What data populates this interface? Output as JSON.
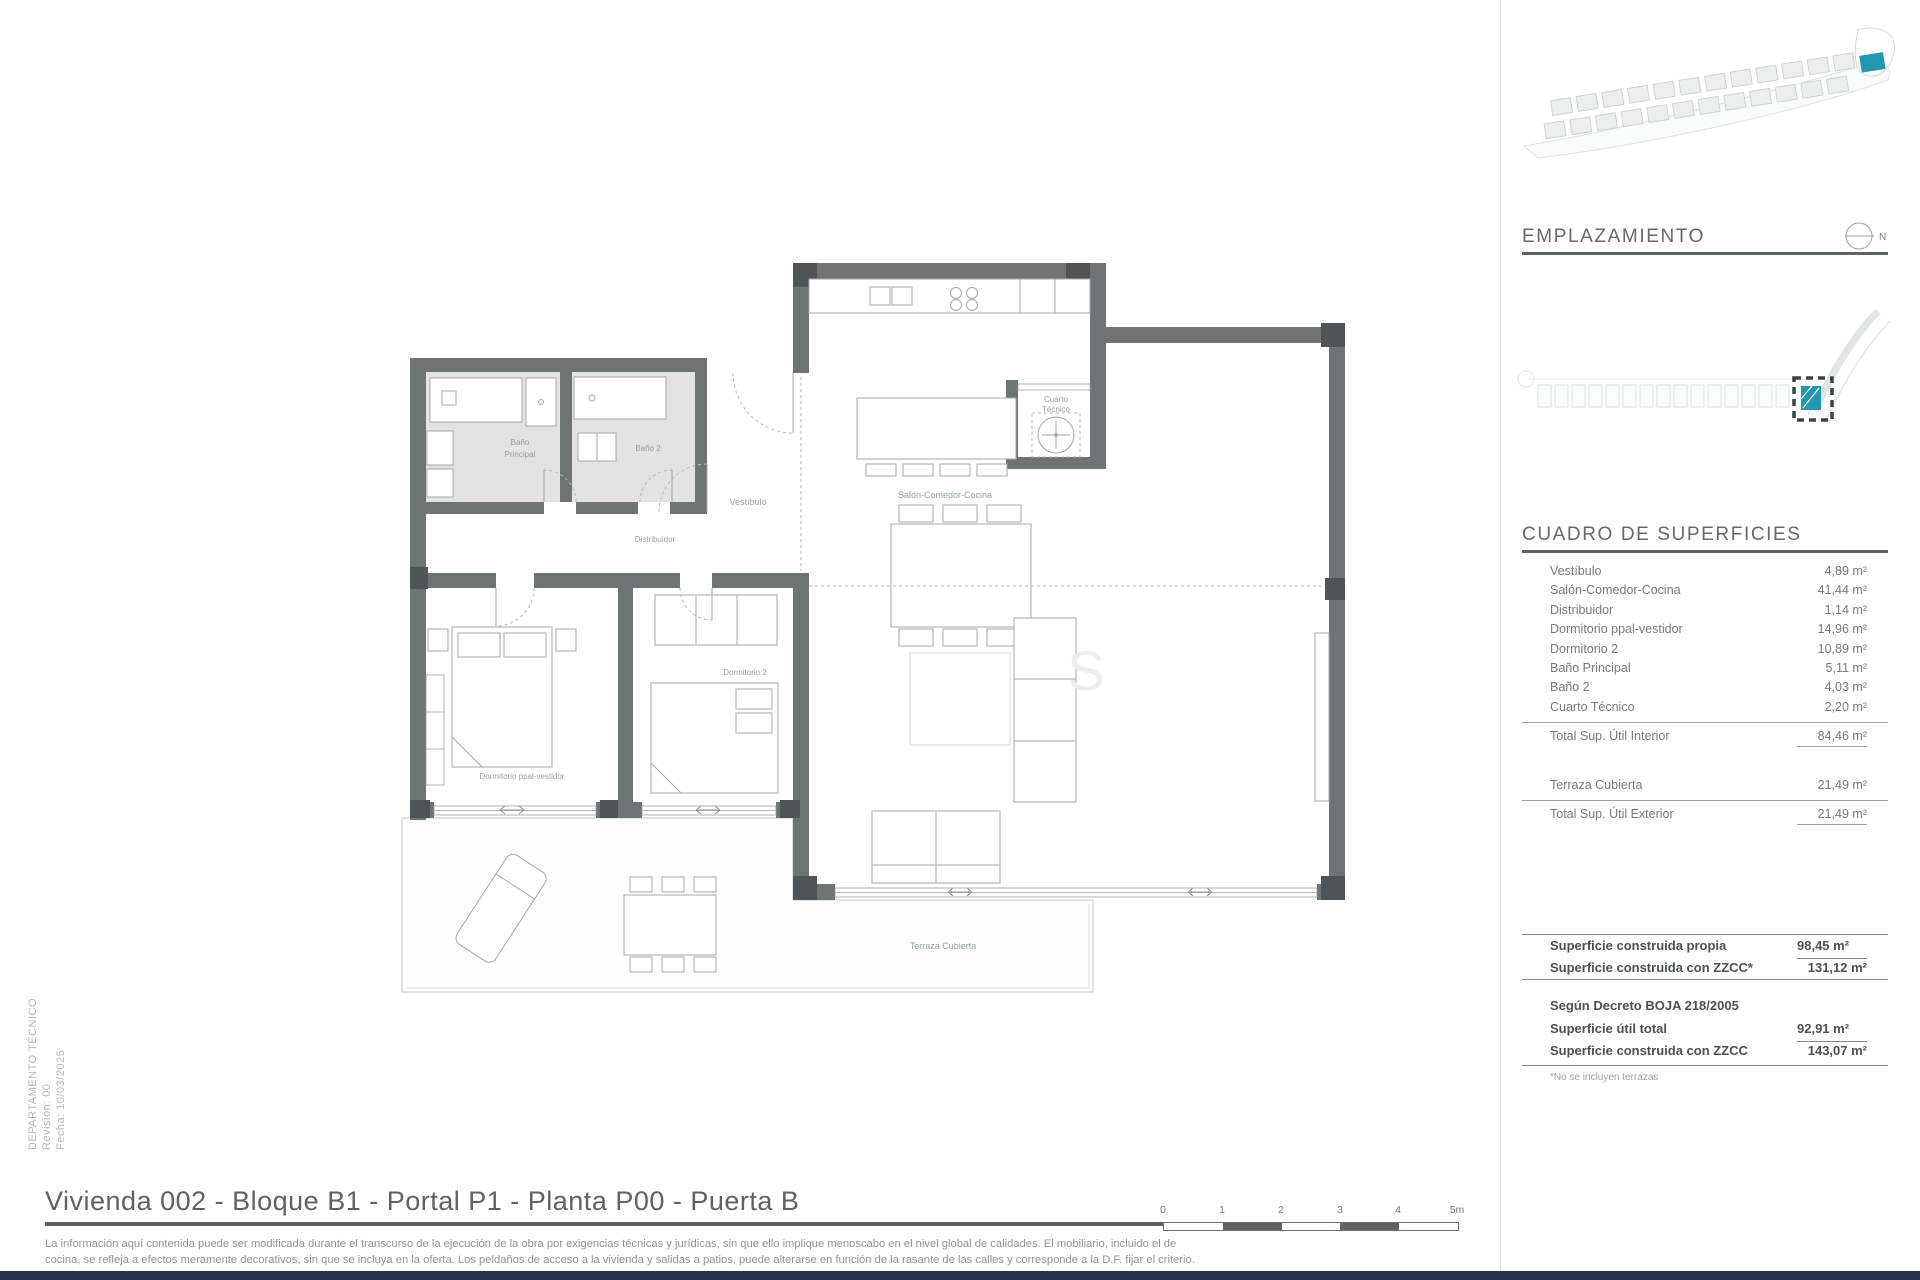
{
  "meta": {
    "department": "DEPARTAMENTO TÉCNICO",
    "revision": "Revisión: 00",
    "date": "Fecha: 10/03/2025"
  },
  "header": {
    "title": "Vivienda 002 - Bloque B1 - Portal P1 - Planta P00 - Puerta B"
  },
  "disclaimer": {
    "line1": "La información aquí contenida puede ser modificada durante el transcurso de la ejecución de la obra por exigencias técnicas y jurídicas, sin que ello implique menoscabo en el nivel global de calidades. El mobiliario, incluido el de",
    "line2": "cocina, se refleja a efectos meramente decorativos, sin que se incluya en la oferta. Los peldaños de acceso a la vivienda y salidas a patios, puede alterarse en función de la rasante de las calles y corresponde a la D.F. fijar el criterio."
  },
  "scalebar": {
    "labels": [
      "0",
      "1",
      "2",
      "3",
      "4",
      "5m"
    ]
  },
  "emplazamiento": {
    "title": "EMPLAZAMIENTO",
    "north": "N"
  },
  "surfaces": {
    "title": "CUADRO DE SUPERFICIES",
    "rooms": [
      {
        "label": "Vestíbulo",
        "value": "4,89 m²"
      },
      {
        "label": "Salón-Comedor-Cocina",
        "value": "41,44 m²"
      },
      {
        "label": "Distribuidor",
        "value": "1,14 m²"
      },
      {
        "label": "Dormitorio ppal-vestidor",
        "value": "14,96 m²"
      },
      {
        "label": "Dormitorio 2",
        "value": "10,89 m²"
      },
      {
        "label": "Baño Principal",
        "value": "5,11 m²"
      },
      {
        "label": "Baño 2",
        "value": "4,03 m²"
      },
      {
        "label": "Cuarto Técnico",
        "value": "2,20 m²"
      }
    ],
    "total_interior": {
      "label": "Total Sup. Útil Interior",
      "value": "84,46 m²"
    },
    "terraza": {
      "label": "Terraza Cubierta",
      "value": "21,49 m²"
    },
    "total_exterior": {
      "label": "Total Sup. Útil Exterior",
      "value": "21,49 m²"
    },
    "built_own": {
      "label": "Superficie construida propia",
      "value": "98,45 m²"
    },
    "built_zzcc": {
      "label": "Superficie construida con ZZCC*",
      "value": "131,12 m²"
    },
    "decree_title": "Según Decreto BOJA 218/2005",
    "util_total": {
      "label": "Superficie útil total",
      "value": "92,91 m²"
    },
    "built_zzcc2": {
      "label": "Superficie construida con ZZCC",
      "value": "143,07 m²"
    },
    "footnote": "*No se incluyen terrazas"
  },
  "plan": {
    "labels": {
      "bano_ppal_1": "Baño",
      "bano_ppal_2": "Principal",
      "bano2": "Baño 2",
      "vestibulo": "Vestíbulo",
      "salon": "Salón-Comedor-Cocina",
      "distribuidor": "Distribuidor",
      "dorm_ppal": "Dormitorio ppal-vestidor",
      "dorm2": "Dormitorio 2",
      "cuarto_1": "Cuarto",
      "cuarto_2": "Técnico",
      "terraza": "Terraza Cubierta",
      "watermark": "S"
    }
  },
  "colors": {
    "accent": "#2397ad",
    "wall": "#6e7474",
    "bottom_bar": "#263349"
  }
}
